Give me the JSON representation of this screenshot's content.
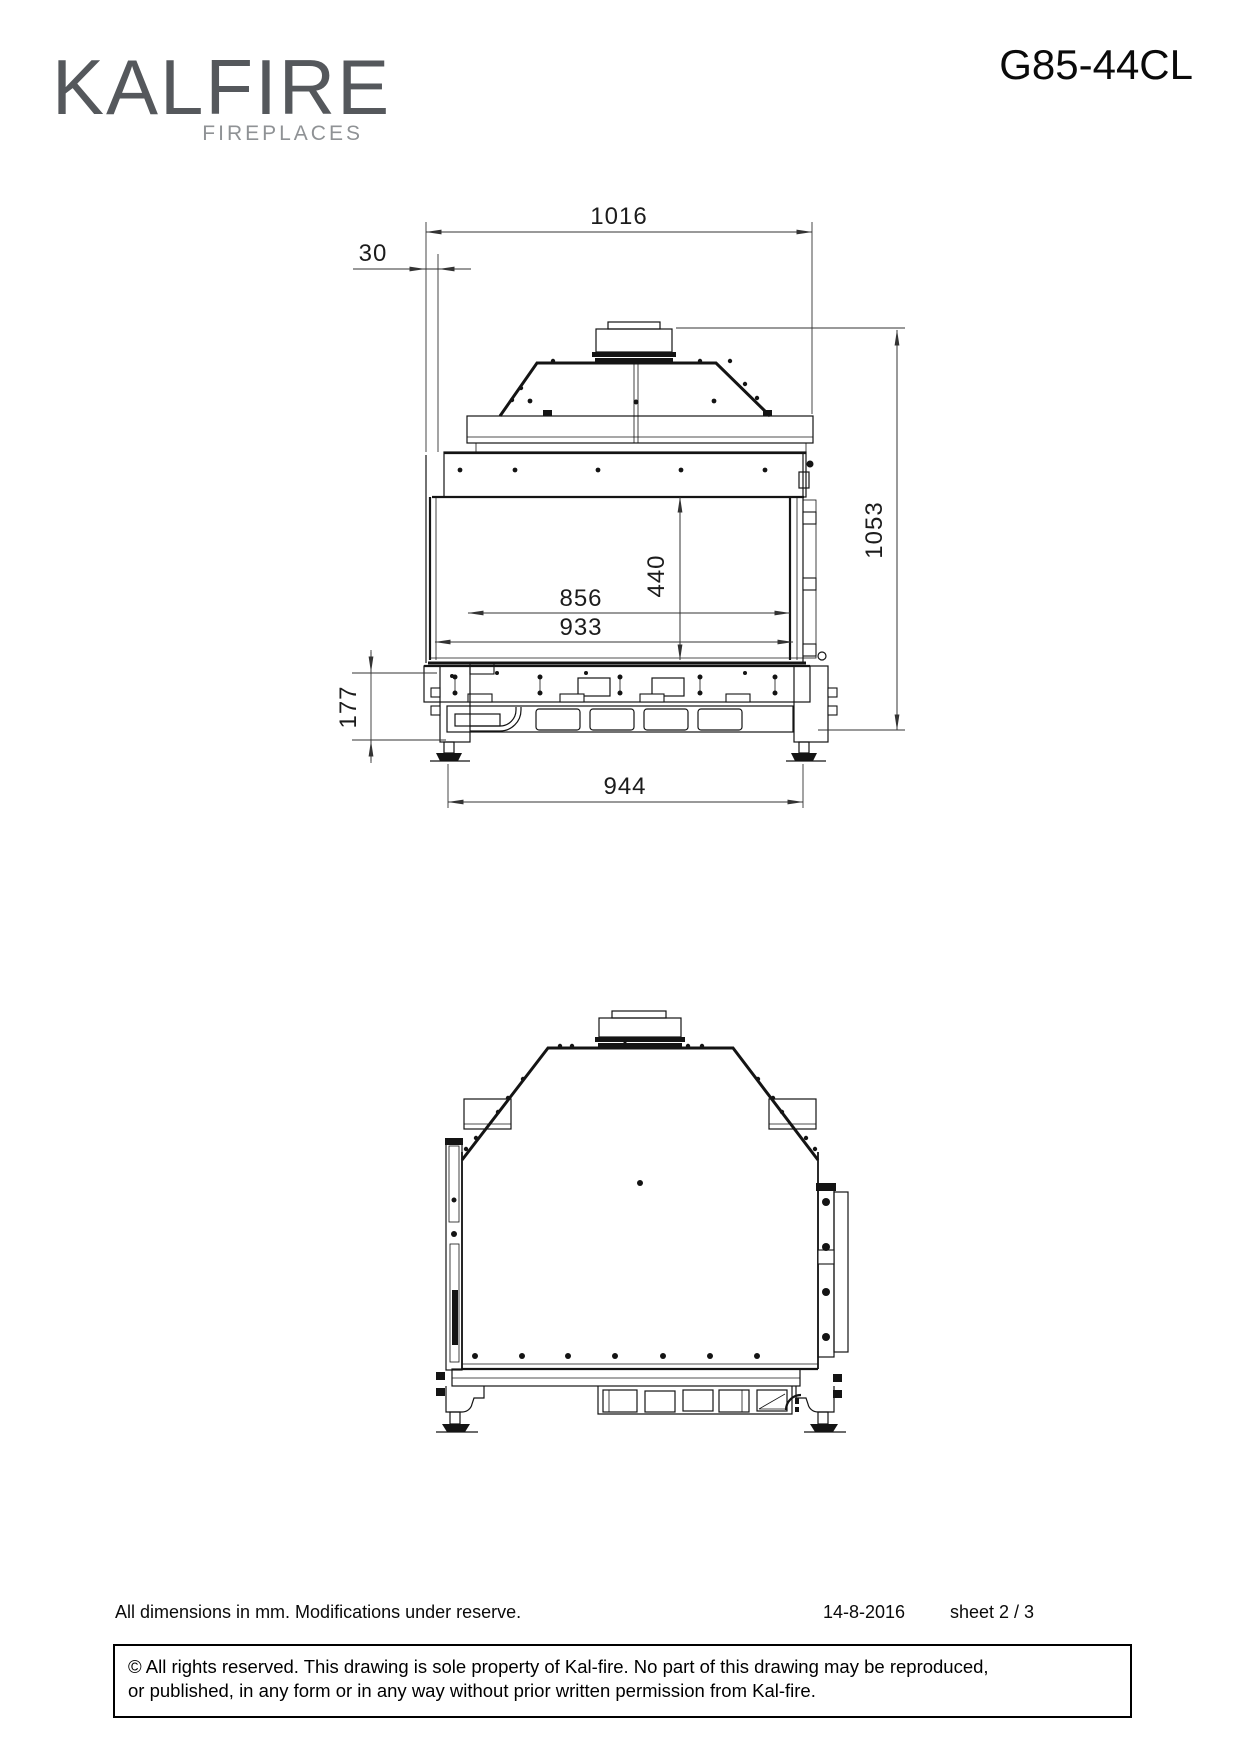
{
  "header": {
    "brand": "KALFIRE",
    "brand_sub": "FIREPLACES",
    "model": "G85-44CL"
  },
  "views": {
    "front": {
      "dims": {
        "total_width": "1016",
        "front_offset": "30",
        "total_height": "1053",
        "door_height": "440",
        "opening_width": "856",
        "glass_width": "933",
        "base_height": "177",
        "feet_span": "944"
      }
    }
  },
  "footer": {
    "note": "All dimensions in mm. Modifications under reserve.",
    "date": "14-8-2016",
    "sheet": "sheet 2 / 3",
    "copyright_line1": "© All rights reserved. This drawing is sole property of Kal-fire. No part of this drawing may be reproduced,",
    "copyright_line2": "or published, in any form or in any way without prior written permission from Kal-fire."
  }
}
